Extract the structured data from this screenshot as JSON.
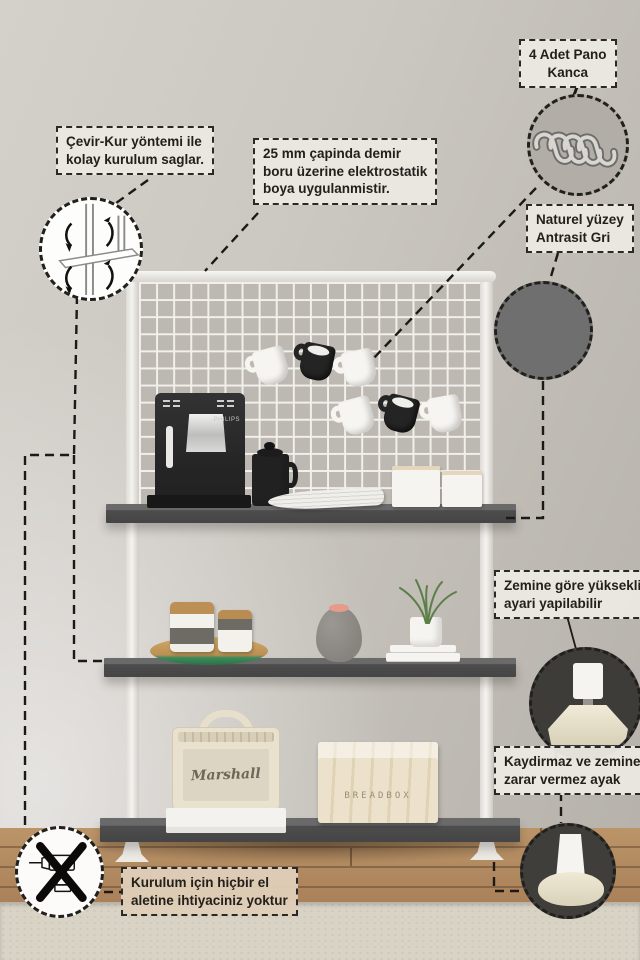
{
  "callouts": {
    "easy_install": {
      "text": "Çevir-Kur yöntemi ile\nkolay kurulum saglar."
    },
    "pipe_paint": {
      "text": "25 mm çapinda demir\nboru üzerine elektrostatik\nboya uygulanmistir."
    },
    "panel_hooks": {
      "text": "4 Adet Pano\nKanca"
    },
    "surface": {
      "text": "Naturel yüzey\nAntrasit Gri"
    },
    "height_adjust": {
      "text": "Zemine göre yükseklik\nayari yapilabilir"
    },
    "foot_safe": {
      "text": "Kaydirmaz ve zemine\nzarar vermez ayak"
    },
    "no_tools": {
      "text": "Kurulum için hiçbir el\naletine ihtiyaciniz yoktur"
    }
  },
  "scene_labels": {
    "coffee_machine_brand": "PHILIPS",
    "speaker_logo": "Marshall",
    "crate_stencil": "BREADBOX"
  },
  "colors": {
    "anthracite_swatch": "#6f6f6f",
    "shelf_anthracite": "#4d4d4d",
    "frame_white": "#f3f1ee",
    "wall_beige": "#c8c4be",
    "callout_background": "#ebe8e2",
    "callout_border": "#2b2926",
    "floor_wood": "#b08a5e",
    "rug_cream": "#d9d3c6",
    "tray_green": "#3e8a5a",
    "vase_lid_pink": "#e59a8c"
  },
  "icons": {
    "hooks_icon": "four metal S panel hooks",
    "swatch_icon": "anthracite gray color swatch",
    "twist_icon": "twist-lock assembly drawing with rotation arrows",
    "no_drill_icon": "drill crossed out with X",
    "adjustable_foot_icon": "height adjustable foot close-up",
    "floor_safe_foot_icon": "non-slip floor-safe foot close-up"
  }
}
